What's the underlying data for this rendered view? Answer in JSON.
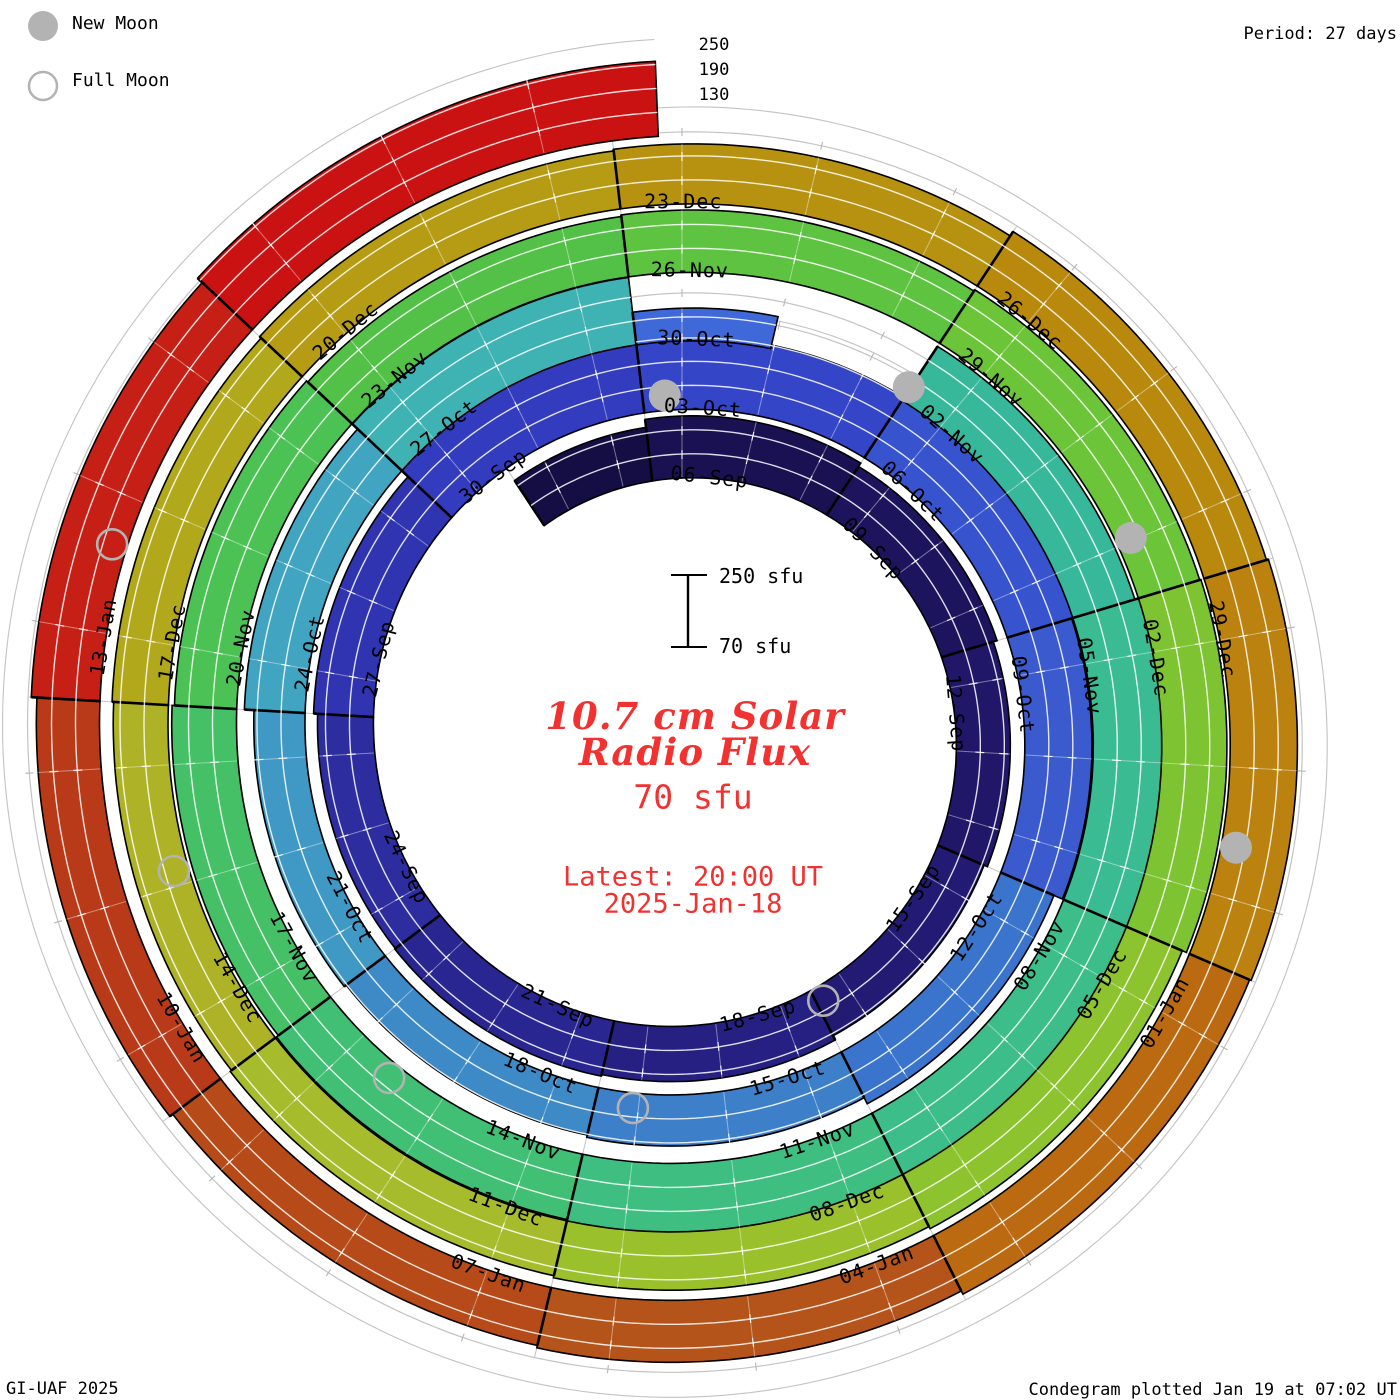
{
  "page": {
    "background": "#ffffff",
    "credit_left": "GI-UAF 2025",
    "credit_right": "Condegram plotted Jan 19 at 07:02 UT",
    "period_note": "Period: 27 days"
  },
  "legend": {
    "new_moon_label": "New Moon",
    "full_moon_label": "Full Moon",
    "moon_gray": "#b3b3b3"
  },
  "center_text": {
    "title_line1": "10.7 cm Solar",
    "title_line2": "Radio Flux",
    "current_value": "70 sfu",
    "latest_line1": "Latest: 20:00 UT",
    "latest_line2": "2025-Jan-18",
    "text_red": "#f23131"
  },
  "scalebar": {
    "top_label": "250 sfu",
    "bottom_label": "70 sfu"
  },
  "radial_axis": {
    "tick_labels": [
      "250",
      "190",
      "130"
    ]
  },
  "chart_data": {
    "type": "bar",
    "subtype": "condegram-spiral-polar-bar",
    "title": "10.7 cm Solar Radio Flux",
    "units": "sfu",
    "days_per_revolution": 27,
    "days_per_segment": 3,
    "flux_baseline": 70,
    "flux_grid_levels": [
      130,
      190,
      250
    ],
    "start_date": "2024-Sep-04",
    "end_date": "2025-Jan-18 20:00 UT",
    "geometry": {
      "cx": 682,
      "cy": 735,
      "r0": 257,
      "growth_per_rev": 68.5,
      "px_per_sfu": 0.4,
      "deg_per_day": 13.3333,
      "segment_phase_days": -0.5,
      "outer_boundary_offset": 97,
      "grid_gray": "#c3c3c3",
      "divider_black": "#000000",
      "tick_gray": "#b5b5b5"
    },
    "segments": [
      {
        "date": "04-Sep",
        "label": "",
        "days": 2,
        "flux": 205,
        "color": "#150e44"
      },
      {
        "date": "06-Sep",
        "flux": 225,
        "color": "#1a1152"
      },
      {
        "date": "09-Sep",
        "flux": 215,
        "color": "#1d145e"
      },
      {
        "date": "12-Sep",
        "flux": 205,
        "color": "#201768"
      },
      {
        "date": "15-Sep",
        "flux": 196,
        "color": "#231a74"
      },
      {
        "date": "18-Sep",
        "flux": 208,
        "color": "#262082"
      },
      {
        "date": "21-Sep",
        "flux": 212,
        "color": "#292691"
      },
      {
        "date": "24-Sep",
        "flux": 210,
        "color": "#2d2da0"
      },
      {
        "date": "27-Sep",
        "flux": 220,
        "color": "#3034b0"
      },
      {
        "date": "30-Sep",
        "flux": 242,
        "color": "#333cbe"
      },
      {
        "date": "03-Oct",
        "flux": 250,
        "color": "#3545c8"
      },
      {
        "date": "06-Oct",
        "flux": 248,
        "color": "#3754ce"
      },
      {
        "date": "09-Oct",
        "flux": 238,
        "color": "#3a5ace"
      },
      {
        "date": "12-Oct",
        "flux": 215,
        "color": "#3b74cc"
      },
      {
        "date": "15-Oct",
        "flux": 198,
        "color": "#3d80c9"
      },
      {
        "date": "18-Oct",
        "flux": 192,
        "color": "#3e8ac7"
      },
      {
        "date": "21-Oct",
        "flux": 198,
        "color": "#4098c4"
      },
      {
        "date": "24-Oct",
        "flux": 222,
        "color": "#41a4c1"
      },
      {
        "date": "27-Oct",
        "flux": 240,
        "color": "#3fb2b4"
      },
      {
        "date": "30-Oct",
        "flux": 152,
        "color": "#3f68d8",
        "bar_frac": 0.49
      },
      {
        "date": "02-Nov",
        "flux": 232,
        "color": "#38b89a"
      },
      {
        "date": "05-Nov",
        "flux": 242,
        "color": "#3abb92"
      },
      {
        "date": "08-Nov",
        "flux": 246,
        "color": "#3cbd8a"
      },
      {
        "date": "11-Nov",
        "flux": 242,
        "color": "#3ebe80"
      },
      {
        "date": "14-Nov",
        "flux": 238,
        "color": "#41bf74"
      },
      {
        "date": "17-Nov",
        "flux": 232,
        "color": "#45c066"
      },
      {
        "date": "20-Nov",
        "flux": 226,
        "color": "#4cc254"
      },
      {
        "date": "23-Nov",
        "flux": 222,
        "color": "#53c148"
      },
      {
        "date": "26-Nov",
        "flux": 226,
        "color": "#5ec341"
      },
      {
        "date": "29-Nov",
        "flux": 230,
        "color": "#6cc438"
      },
      {
        "date": "02-Dec",
        "flux": 233,
        "color": "#7ec432"
      },
      {
        "date": "05-Dec",
        "flux": 222,
        "color": "#8cc32e"
      },
      {
        "date": "08-Dec",
        "flux": 216,
        "color": "#9ac02c"
      },
      {
        "date": "11-Dec",
        "flux": 211,
        "color": "#a6bc2c"
      },
      {
        "date": "14-Dec",
        "flux": 207,
        "color": "#aeb226"
      },
      {
        "date": "17-Dec",
        "flux": 211,
        "color": "#b2a81c"
      },
      {
        "date": "20-Dec",
        "flux": 216,
        "color": "#b59c14"
      },
      {
        "date": "23-Dec",
        "flux": 220,
        "color": "#b79210"
      },
      {
        "date": "26-Dec",
        "flux": 233,
        "color": "#b9890e"
      },
      {
        "date": "29-Dec",
        "flux": 238,
        "color": "#bb8210"
      },
      {
        "date": "01-Jan",
        "flux": 234,
        "color": "#bc6a12"
      },
      {
        "date": "04-Jan",
        "flux": 225,
        "color": "#b5541a"
      },
      {
        "date": "07-Jan",
        "flux": 219,
        "color": "#b64a18"
      },
      {
        "date": "10-Jan",
        "flux": 228,
        "color": "#b93a18"
      },
      {
        "date": "13-Jan",
        "flux": 242,
        "color": "#c62016"
      },
      {
        "date": "16-Jan",
        "label": "",
        "days": 3.33,
        "flux": 258,
        "color": "#cb1212"
      }
    ],
    "moons": [
      {
        "type": "new",
        "date": "02-Oct",
        "theta": 357.1
      },
      {
        "type": "new",
        "date": "01-Nov",
        "theta": 753.1
      },
      {
        "type": "new",
        "date": "01-Dec",
        "theta": 1146.3
      },
      {
        "type": "new",
        "date": "30-Dec",
        "theta": 1541.5
      },
      {
        "type": "full",
        "date": "17-Sep",
        "theta": 152.0
      },
      {
        "type": "full",
        "date": "17-Oct",
        "theta": 547.5
      },
      {
        "type": "full",
        "date": "15-Nov",
        "theta": 940.5
      },
      {
        "type": "full",
        "date": "15-Dec",
        "theta": 1335.0
      },
      {
        "type": "full",
        "date": "13-Jan",
        "theta": 1728.5
      }
    ]
  }
}
